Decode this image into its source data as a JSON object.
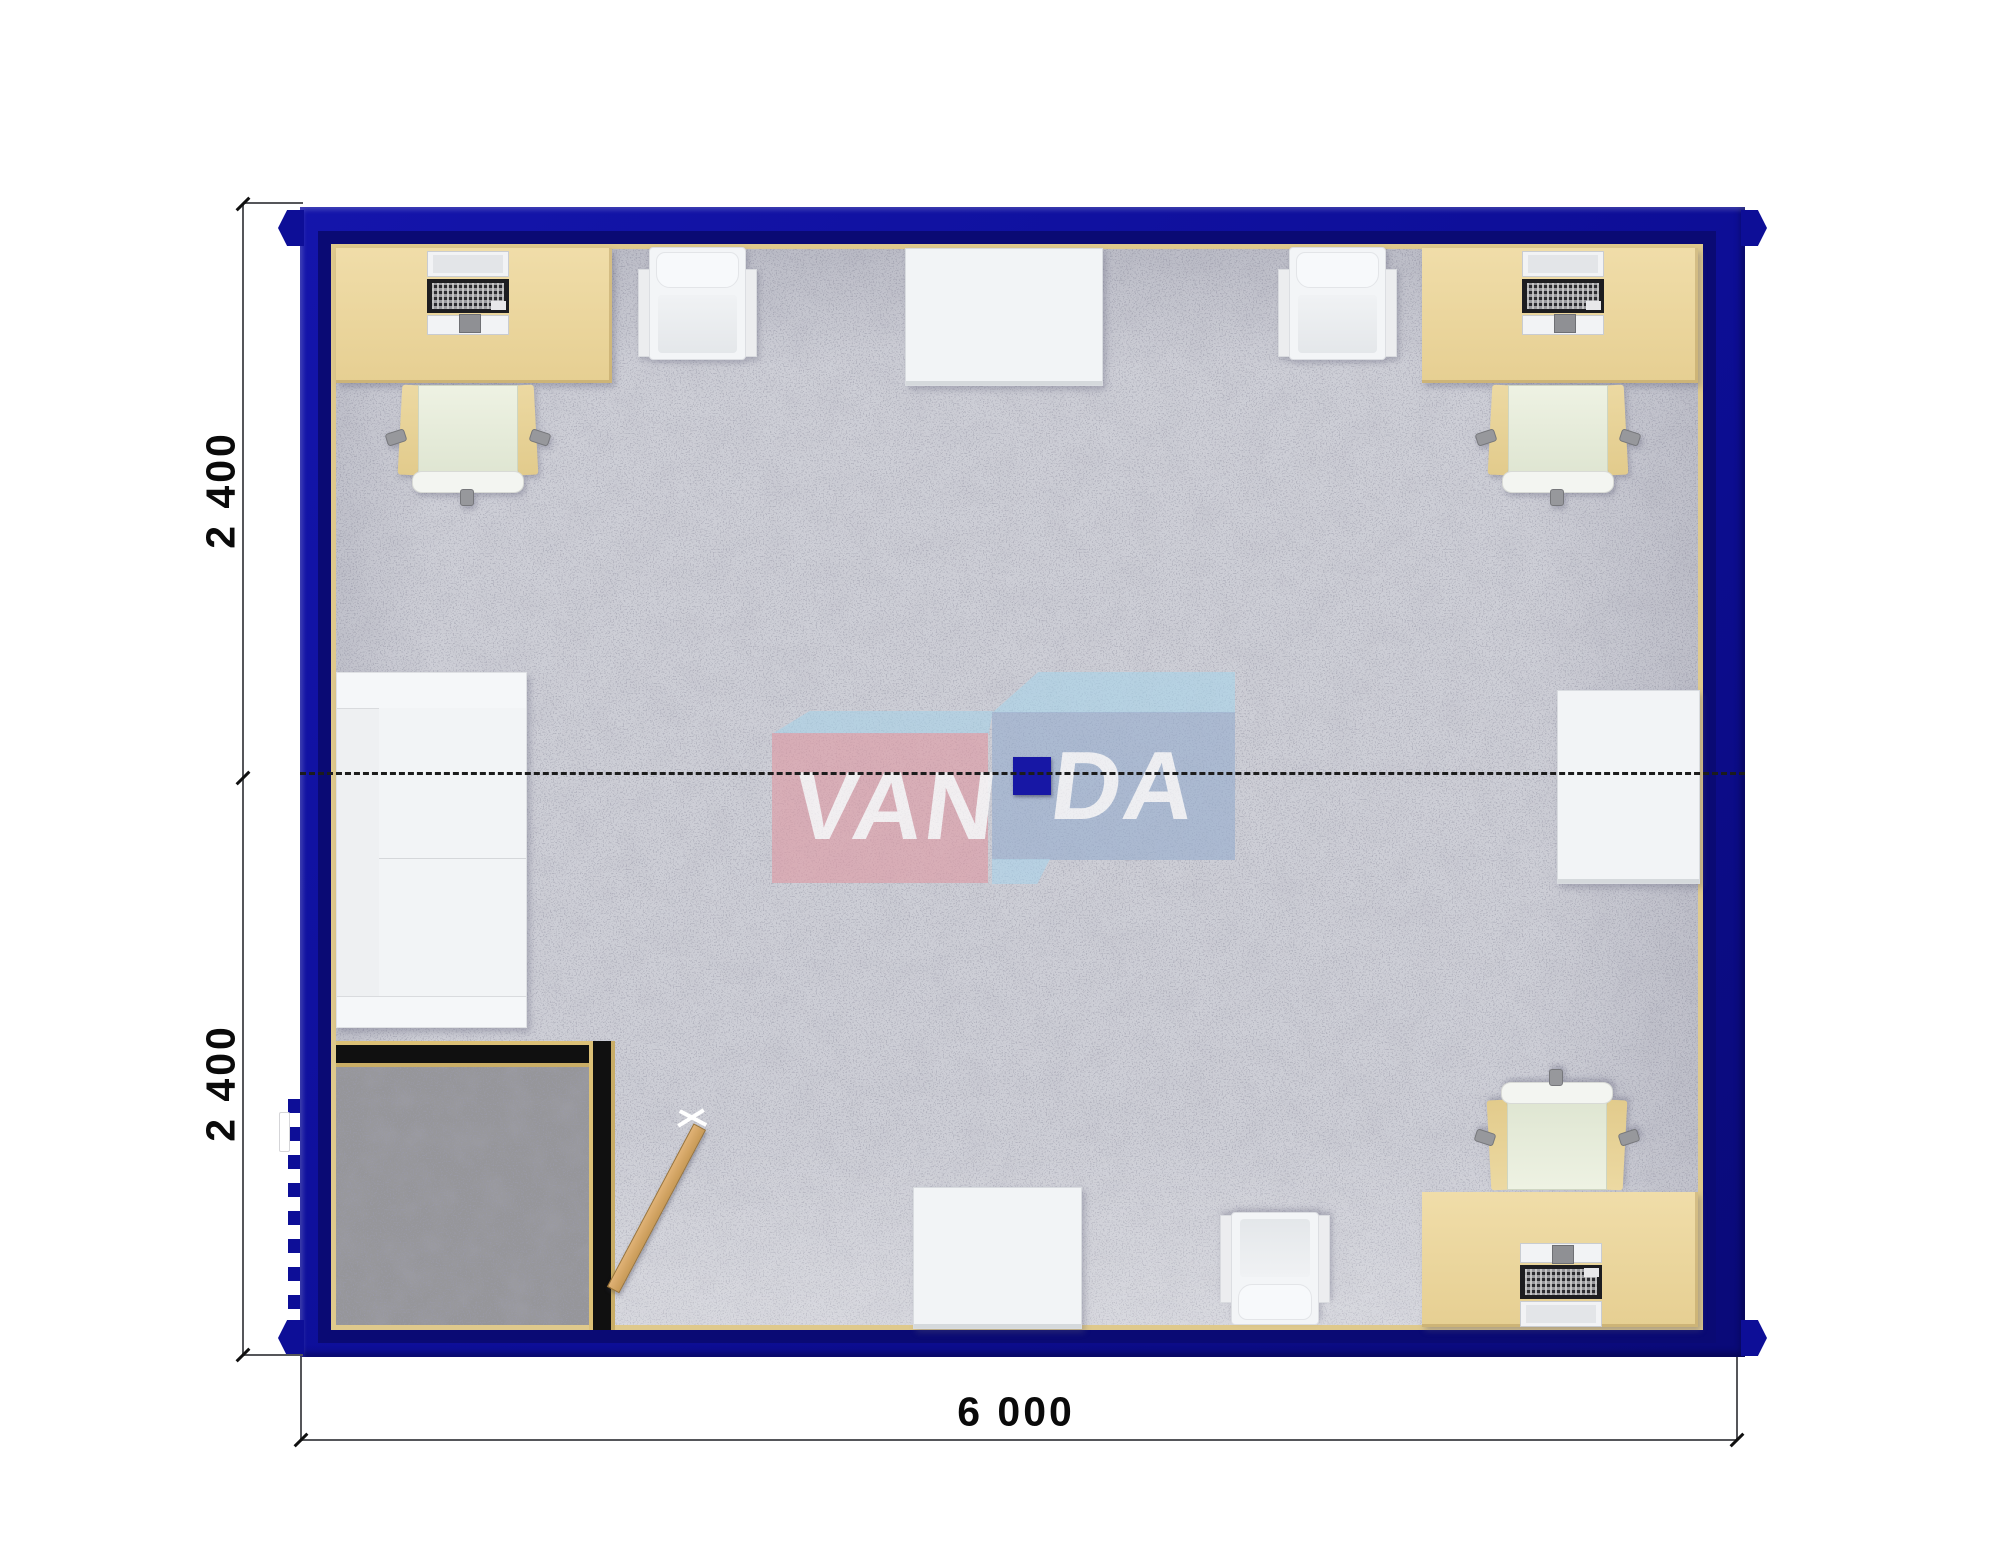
{
  "title": "Modular office container floor plan (top view)",
  "dimensions": {
    "left_top_label": "2 400",
    "left_bottom_label": "2 400",
    "bottom_label": "6 000"
  },
  "watermark": {
    "part1": "VAN",
    "part2": "DA"
  },
  "colors": {
    "wall_navy": "#0d0e97",
    "wall_inner_navy": "#0a0a74",
    "panel_edge_tan": "#dfc98c",
    "carpet_gray": "#cdced6",
    "entry_carpet_gray": "#96969a",
    "desk_beige": "#ebd79e",
    "chair_seat_pale": "#eef2e3",
    "white_furniture": "#f2f4f6",
    "entry_wall_black": "#101010",
    "door_wood": "#d7a96b",
    "column_navy": "#1717a5",
    "logo_pink": "#e099a4",
    "logo_light_blue": "#a8d4eb",
    "logo_steel_blue": "#94adcd"
  },
  "furniture": [
    {
      "name": "desk-with-computer",
      "count": 3
    },
    {
      "name": "office-chair",
      "count": 3
    },
    {
      "name": "armchair",
      "count": 3
    },
    {
      "name": "white-side-table",
      "count": 3
    },
    {
      "name": "sofa",
      "count": 1
    },
    {
      "name": "entry-vestibule",
      "count": 1
    },
    {
      "name": "swing-door",
      "count": 1
    },
    {
      "name": "support-column",
      "count": 1
    }
  ]
}
